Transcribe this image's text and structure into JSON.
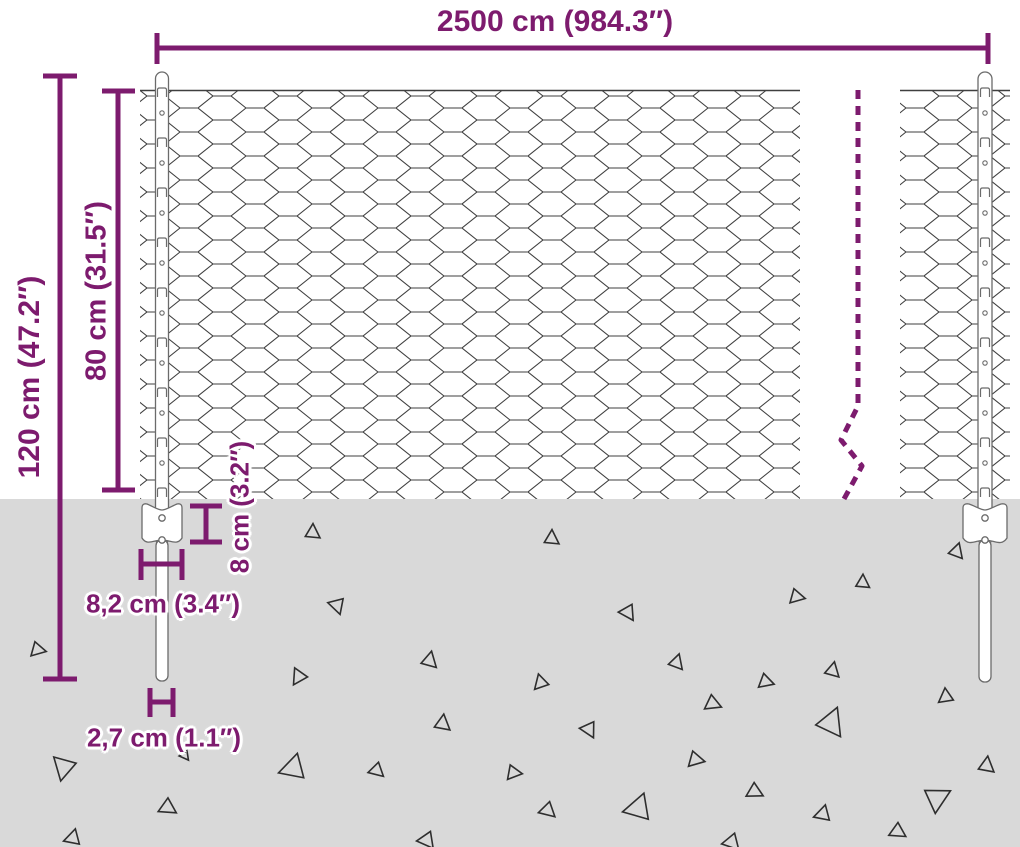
{
  "page": {
    "background": "#ffffff"
  },
  "dimensions": {
    "accent_color": "#7d1b6e",
    "total_width": {
      "label": "2500 cm (984.3″)"
    },
    "post_height": {
      "label": "120 cm (47.2″)"
    },
    "mesh_height": {
      "label": "80 cm (31.5″)"
    },
    "plate_height": {
      "label": "8 cm (3.2″)"
    },
    "plate_width": {
      "label": "8,2 cm (3.4″)"
    },
    "post_diameter": {
      "label": "2,7 cm (1.1″)"
    }
  },
  "fence": {
    "mesh_type": "hexagonal-wire-mesh",
    "wire_color": "#3f3f3f",
    "post_fill": "#ffffff",
    "post_outline": "#6b6b6b"
  },
  "ground": {
    "color": "#d9d9d9",
    "debris_outline": "#2e2e2e",
    "debris": [
      {
        "x": 38,
        "y": 650,
        "s": 14,
        "r": 100
      },
      {
        "x": 63,
        "y": 768,
        "s": 22,
        "r": 190
      },
      {
        "x": 72,
        "y": 838,
        "s": 15,
        "r": 250
      },
      {
        "x": 168,
        "y": 808,
        "s": 16,
        "r": 120
      },
      {
        "x": 185,
        "y": 756,
        "s": 9,
        "r": 140
      },
      {
        "x": 313,
        "y": 532,
        "s": 14,
        "r": 0
      },
      {
        "x": 337,
        "y": 606,
        "s": 15,
        "r": 160
      },
      {
        "x": 298,
        "y": 677,
        "s": 15,
        "r": 210
      },
      {
        "x": 292,
        "y": 768,
        "s": 24,
        "r": 250
      },
      {
        "x": 377,
        "y": 771,
        "s": 14,
        "r": 130
      },
      {
        "x": 430,
        "y": 660,
        "s": 15,
        "r": 10
      },
      {
        "x": 443,
        "y": 723,
        "s": 15,
        "r": 5
      },
      {
        "x": 427,
        "y": 841,
        "s": 16,
        "r": 140
      },
      {
        "x": 514,
        "y": 773,
        "s": 14,
        "r": 95
      },
      {
        "x": 548,
        "y": 811,
        "s": 15,
        "r": 130
      },
      {
        "x": 552,
        "y": 538,
        "s": 14,
        "r": 0
      },
      {
        "x": 540,
        "y": 683,
        "s": 14,
        "r": 220
      },
      {
        "x": 589,
        "y": 730,
        "s": 15,
        "r": 150
      },
      {
        "x": 628,
        "y": 613,
        "s": 15,
        "r": 145
      },
      {
        "x": 637,
        "y": 808,
        "s": 25,
        "r": 255
      },
      {
        "x": 677,
        "y": 662,
        "s": 14,
        "r": 15
      },
      {
        "x": 696,
        "y": 760,
        "s": 15,
        "r": 100
      },
      {
        "x": 713,
        "y": 704,
        "s": 15,
        "r": 110
      },
      {
        "x": 732,
        "y": 843,
        "s": 16,
        "r": 135
      },
      {
        "x": 755,
        "y": 792,
        "s": 15,
        "r": 115
      },
      {
        "x": 766,
        "y": 682,
        "s": 14,
        "r": 105
      },
      {
        "x": 797,
        "y": 597,
        "s": 14,
        "r": 100
      },
      {
        "x": 822,
        "y": 814,
        "s": 15,
        "r": 250
      },
      {
        "x": 832,
        "y": 722,
        "s": 26,
        "r": 20
      },
      {
        "x": 833,
        "y": 670,
        "s": 14,
        "r": 10
      },
      {
        "x": 863,
        "y": 582,
        "s": 13,
        "r": 0
      },
      {
        "x": 898,
        "y": 832,
        "s": 15,
        "r": 120
      },
      {
        "x": 938,
        "y": 798,
        "s": 24,
        "r": 60
      },
      {
        "x": 945,
        "y": 697,
        "s": 14,
        "r": 230
      },
      {
        "x": 957,
        "y": 551,
        "s": 14,
        "r": 15
      },
      {
        "x": 987,
        "y": 765,
        "s": 15,
        "r": 5
      }
    ]
  }
}
